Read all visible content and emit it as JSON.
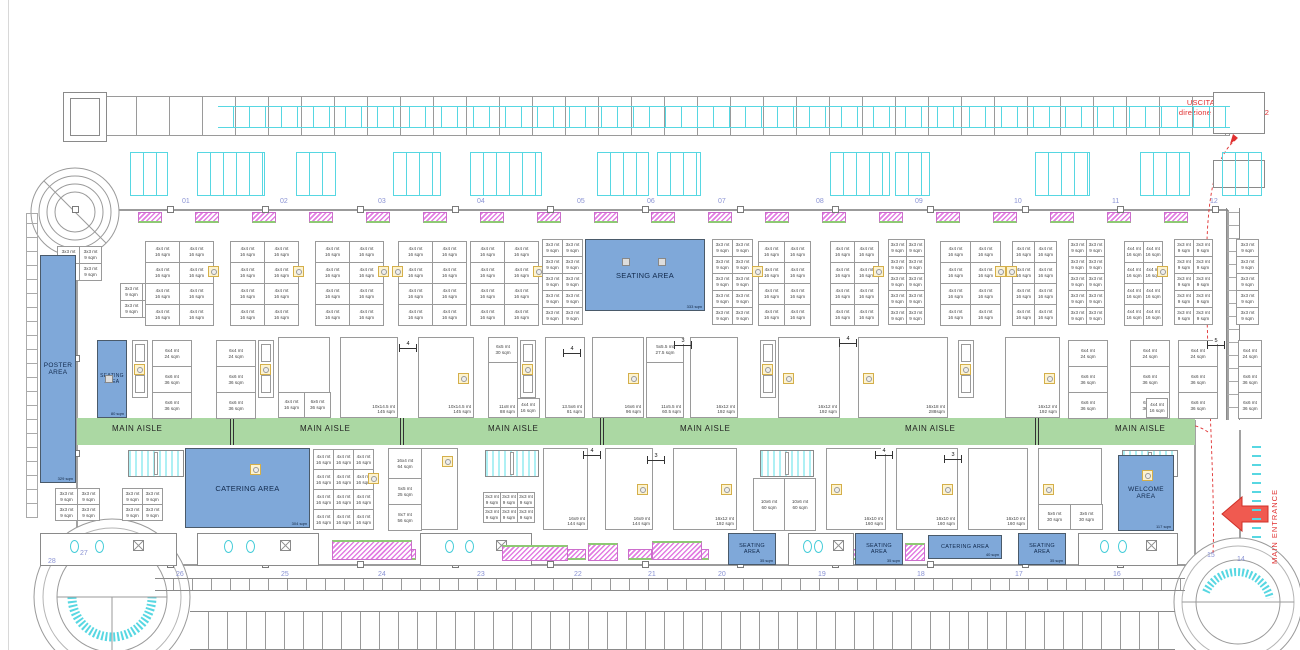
{
  "labels": {
    "main_aisle": "MAIN AISLE",
    "exit_line1": "USCITA AREA EXPO",
    "exit_line2": "direzione MiCo Sud liv +2",
    "main_entrance": "MAIN ENTRANCE"
  },
  "colors": {
    "area_blue": "#7fa8d9",
    "aisle_green": "#abd8a3",
    "alert_red": "#e03030",
    "cad_cyan": "#57d7e2",
    "cad_magenta": "#e27ce2",
    "number_blue": "#8a93d4",
    "booth_gray": "#9a9a9a",
    "marker_yellow": "#d4af4a"
  },
  "cell_types": {
    "t44": "4x4 mt\n16 sqm",
    "t33": "3x3 mt\n9 sqm",
    "c24": "6x4 mt\n24 sqm",
    "c36": "6x6 mt\n36 sqm",
    "c16": "4x4 mt\n16 sqm",
    "t60": "10x6 mt\n60 sqm"
  },
  "areas": [
    {
      "id": "poster-area",
      "label": "POSTER\nAREA",
      "sqm": "329 sqm",
      "x": 40,
      "y": 255,
      "w": 36,
      "h": 228,
      "fs": 6.5
    },
    {
      "id": "seating-area-left",
      "label": "SEATING\nAREA",
      "sqm": "80 sqm",
      "x": 97,
      "y": 340,
      "w": 30,
      "h": 78,
      "fs": 5
    },
    {
      "id": "seating-area-top",
      "label": "SEATING AREA",
      "sqm": "333 sqm",
      "x": 585,
      "y": 239,
      "w": 120,
      "h": 72,
      "fs": 7.5
    },
    {
      "id": "catering-area-main",
      "label": "CATERING AREA",
      "sqm": "304 sqm",
      "x": 185,
      "y": 448,
      "w": 125,
      "h": 80,
      "fs": 7.5
    },
    {
      "id": "welcome-area",
      "label": "WELCOME\nAREA",
      "sqm": "117 sqm",
      "x": 1118,
      "y": 455,
      "w": 56,
      "h": 76,
      "fs": 6.5
    },
    {
      "id": "seating-area-b1",
      "label": "SEATING\nAREA",
      "sqm": "35 sqm",
      "x": 728,
      "y": 533,
      "w": 48,
      "h": 32,
      "fs": 5.5
    },
    {
      "id": "seating-area-b2",
      "label": "SEATING\nAREA",
      "sqm": "35 sqm",
      "x": 855,
      "y": 533,
      "w": 48,
      "h": 32,
      "fs": 5.5
    },
    {
      "id": "catering-area-b",
      "label": "CATERING AREA",
      "sqm": "40 sqm",
      "x": 928,
      "y": 535,
      "w": 74,
      "h": 24,
      "fs": 5.5
    },
    {
      "id": "seating-area-b3",
      "label": "SEATING\nAREA",
      "sqm": "35 sqm",
      "x": 1018,
      "y": 533,
      "w": 48,
      "h": 32,
      "fs": 5.5
    }
  ],
  "aisle": {
    "x": 77,
    "y": 418,
    "w": 1118,
    "h": 27,
    "label_y": 424,
    "label_xs": [
      112,
      300,
      488,
      680,
      905,
      1115
    ],
    "tick_xs": [
      230,
      400,
      600,
      1035
    ]
  },
  "top_numbers": {
    "y": 198,
    "items": [
      {
        "n": "01",
        "x": 182
      },
      {
        "n": "02",
        "x": 280
      },
      {
        "n": "03",
        "x": 378
      },
      {
        "n": "04",
        "x": 477
      },
      {
        "n": "05",
        "x": 577
      },
      {
        "n": "06",
        "x": 647
      },
      {
        "n": "07",
        "x": 718
      },
      {
        "n": "08",
        "x": 816
      },
      {
        "n": "09",
        "x": 915
      },
      {
        "n": "10",
        "x": 1014
      },
      {
        "n": "11",
        "x": 1112
      },
      {
        "n": "12",
        "x": 1210
      }
    ]
  },
  "bottom_numbers": [
    {
      "n": "28",
      "x": 48,
      "y": 558
    },
    {
      "n": "27",
      "x": 80,
      "y": 550
    },
    {
      "n": "26",
      "x": 176,
      "y": 571
    },
    {
      "n": "25",
      "x": 281,
      "y": 571
    },
    {
      "n": "24",
      "x": 378,
      "y": 571
    },
    {
      "n": "23",
      "x": 477,
      "y": 571
    },
    {
      "n": "22",
      "x": 574,
      "y": 571
    },
    {
      "n": "21",
      "x": 648,
      "y": 571
    },
    {
      "n": "20",
      "x": 718,
      "y": 571
    },
    {
      "n": "19",
      "x": 818,
      "y": 571
    },
    {
      "n": "18",
      "x": 917,
      "y": 571
    },
    {
      "n": "17",
      "x": 1015,
      "y": 571
    },
    {
      "n": "16",
      "x": 1113,
      "y": 571
    },
    {
      "n": "15",
      "x": 1207,
      "y": 552
    },
    {
      "n": "14",
      "x": 1237,
      "y": 556
    }
  ],
  "booth_blocks": [
    {
      "x": 57,
      "y": 246,
      "cols": 2,
      "rows": 2,
      "cw": 22,
      "ch": 17,
      "type": "t33"
    },
    {
      "x": 120,
      "y": 283,
      "cols": 2,
      "rows": 2,
      "cw": 22,
      "ch": 17,
      "type": "t33"
    },
    {
      "x": 145,
      "y": 241,
      "cols": 2,
      "rows": 4,
      "cw": 34,
      "ch": 21,
      "type": "t44",
      "m": 1
    },
    {
      "x": 230,
      "y": 241,
      "cols": 2,
      "rows": 4,
      "cw": 34,
      "ch": 21,
      "type": "t44",
      "m": 1
    },
    {
      "x": 315,
      "y": 241,
      "cols": 2,
      "rows": 4,
      "cw": 34,
      "ch": 21,
      "type": "t44",
      "m": 1
    },
    {
      "x": 398,
      "y": 241,
      "cols": 2,
      "rows": 4,
      "cw": 34,
      "ch": 21,
      "type": "t44",
      "m": 0
    },
    {
      "x": 470,
      "y": 241,
      "cols": 2,
      "rows": 4,
      "cw": 34,
      "ch": 21,
      "type": "t44",
      "m": 1
    },
    {
      "x": 542,
      "y": 239,
      "cols": 2,
      "rows": 5,
      "cw": 20,
      "ch": 17,
      "type": "t33"
    },
    {
      "x": 712,
      "y": 239,
      "cols": 2,
      "rows": 5,
      "cw": 20,
      "ch": 17,
      "type": "t33"
    },
    {
      "x": 758,
      "y": 241,
      "cols": 2,
      "rows": 4,
      "cw": 26,
      "ch": 21,
      "type": "t44",
      "m": 0
    },
    {
      "x": 830,
      "y": 241,
      "cols": 2,
      "rows": 4,
      "cw": 24,
      "ch": 21,
      "type": "t44",
      "m": 1
    },
    {
      "x": 888,
      "y": 239,
      "cols": 2,
      "rows": 5,
      "cw": 18,
      "ch": 17,
      "type": "t33"
    },
    {
      "x": 940,
      "y": 241,
      "cols": 2,
      "rows": 4,
      "cw": 30,
      "ch": 21,
      "type": "t44",
      "m": 1
    },
    {
      "x": 1012,
      "y": 241,
      "cols": 2,
      "rows": 4,
      "cw": 22,
      "ch": 21,
      "type": "t44",
      "m": 0
    },
    {
      "x": 1068,
      "y": 239,
      "cols": 2,
      "rows": 5,
      "cw": 18,
      "ch": 17,
      "type": "t33"
    },
    {
      "x": 1124,
      "y": 241,
      "cols": 2,
      "rows": 4,
      "cw": 19,
      "ch": 21,
      "type": "t44",
      "m": 1
    },
    {
      "x": 1174,
      "y": 239,
      "cols": 2,
      "rows": 5,
      "cw": 19,
      "ch": 17,
      "type": "t33"
    },
    {
      "x": 1236,
      "y": 239,
      "cols": 1,
      "rows": 5,
      "cw": 22,
      "ch": 17,
      "type": "t33"
    },
    {
      "x": 55,
      "y": 488,
      "cols": 2,
      "rows": 2,
      "cw": 22,
      "ch": 16,
      "type": "t33"
    },
    {
      "x": 122,
      "y": 488,
      "cols": 2,
      "rows": 2,
      "cw": 20,
      "ch": 16,
      "type": "t33"
    },
    {
      "x": 313,
      "y": 449,
      "cols": 3,
      "rows": 4,
      "cw": 20,
      "ch": 20,
      "type": "t44",
      "m": 1
    },
    {
      "x": 483,
      "y": 492,
      "cols": 3,
      "rows": 2,
      "cw": 17,
      "ch": 15,
      "type": "t33"
    },
    {
      "x": 753,
      "y": 478,
      "cols": 2,
      "rows": 1,
      "cw": 31,
      "ch": 52,
      "type": "t60"
    }
  ],
  "stack_blocks": [
    {
      "x": 152,
      "y": 340,
      "w": 40
    },
    {
      "x": 216,
      "y": 340,
      "w": 40
    },
    {
      "x": 1068,
      "y": 340,
      "w": 40
    },
    {
      "x": 1130,
      "y": 340,
      "w": 40
    },
    {
      "x": 1178,
      "y": 340,
      "w": 40
    },
    {
      "x": 1238,
      "y": 340,
      "w": 24
    }
  ],
  "stack_cells": [
    "c24",
    "c36",
    "c36"
  ],
  "big_booths": [
    {
      "x": 278,
      "y": 337,
      "w": 52,
      "h": 81,
      "l": "",
      "bottom": [
        "4x4 mt\n16 sqm",
        "6x6 mt\n36 sqm"
      ]
    },
    {
      "x": 340,
      "y": 337,
      "w": 58,
      "h": 81,
      "l": "10x14.5 mt\n145 sqm"
    },
    {
      "x": 418,
      "y": 337,
      "w": 56,
      "h": 81,
      "l": "10x14.5 mt\n145 sqm",
      "m": 1
    },
    {
      "x": 488,
      "y": 337,
      "w": 30,
      "h": 81,
      "l": "11x8 mt\n88 sqm",
      "top": "6x5 mt\n30 sqm"
    },
    {
      "x": 545,
      "y": 337,
      "w": 40,
      "h": 81,
      "l": "13.5x6 mt\n81 sqm"
    },
    {
      "x": 592,
      "y": 337,
      "w": 52,
      "h": 81,
      "l": "16x6 mt\n96 sqm",
      "m": 1
    },
    {
      "x": 646,
      "y": 337,
      "w": 38,
      "h": 81,
      "l": "11x5.5 mt\n60.5 sqm",
      "top": "5x5.5 mt\n27.5 sqm"
    },
    {
      "x": 690,
      "y": 337,
      "w": 48,
      "h": 81,
      "l": "16x12 mt\n192 sqm"
    },
    {
      "x": 778,
      "y": 337,
      "w": 62,
      "h": 81,
      "l": "16x12 mt\n192 sqm",
      "m": 0
    },
    {
      "x": 858,
      "y": 337,
      "w": 90,
      "h": 81,
      "l": "16x18 mt\n288sqm",
      "m": 0
    },
    {
      "x": 1005,
      "y": 337,
      "w": 55,
      "h": 81,
      "l": "16x12 mt\n192 sqm",
      "m": 1
    },
    {
      "x": 543,
      "y": 448,
      "w": 45,
      "h": 82,
      "l": "16x9 mt\n144 sqm"
    },
    {
      "x": 605,
      "y": 448,
      "w": 48,
      "h": 82,
      "l": "16x9 mt\n144 sqm",
      "m": 1
    },
    {
      "x": 673,
      "y": 448,
      "w": 64,
      "h": 82,
      "l": "16x12 mt\n192 sqm",
      "m": 1
    },
    {
      "x": 826,
      "y": 448,
      "w": 60,
      "h": 82,
      "l": "16x10 mt\n160 sqm",
      "m": 0
    },
    {
      "x": 896,
      "y": 448,
      "w": 62,
      "h": 82,
      "l": "16x10 mt\n160 sqm",
      "m": 1
    },
    {
      "x": 968,
      "y": 448,
      "w": 60,
      "h": 82,
      "l": "16x10 mt\n160 sqm"
    },
    {
      "x": 1038,
      "y": 448,
      "w": 64,
      "h": 82,
      "l": "11x12 mt\n132 sqm",
      "m": 0,
      "bottom": [
        "5x6 mt\n30 sqm",
        "3x6 mt\n30 sqm"
      ]
    }
  ],
  "column_booth": {
    "x": 388,
    "y": 448,
    "w": 70,
    "leftw": 34,
    "cells": [
      {
        "l": "16x4 mt\n64 sqm",
        "h": 30
      },
      {
        "l": "5x5 mt\n25 sqm",
        "h": 26
      },
      {
        "l": "8x7 mt\n56 sqm",
        "h": 26
      }
    ]
  },
  "under_strip_cells": [
    {
      "x": 516,
      "y": 398,
      "w": 24,
      "h": 20
    },
    {
      "x": 1146,
      "y": 398,
      "w": 22,
      "h": 20
    }
  ],
  "dims": [
    {
      "x": 408,
      "y": 344,
      "t": "4"
    },
    {
      "x": 572,
      "y": 349,
      "t": "4"
    },
    {
      "x": 683,
      "y": 341,
      "t": "3"
    },
    {
      "x": 848,
      "y": 339,
      "t": "4"
    },
    {
      "x": 1216,
      "y": 341,
      "t": "5"
    },
    {
      "x": 592,
      "y": 451,
      "t": "4"
    },
    {
      "x": 656,
      "y": 456,
      "t": "3"
    },
    {
      "x": 884,
      "y": 451,
      "t": "4"
    },
    {
      "x": 953,
      "y": 455,
      "t": "3"
    }
  ],
  "strips": [
    132,
    258,
    520,
    760,
    958,
    1150
  ],
  "escalators": [
    {
      "x": 128,
      "w": 56
    },
    {
      "x": 485,
      "w": 54
    },
    {
      "x": 760,
      "w": 54
    },
    {
      "x": 1122,
      "w": 56
    }
  ],
  "decor": {
    "radiators_top": [
      138,
      195,
      252,
      309,
      366,
      423,
      480,
      537,
      594,
      651,
      708,
      765,
      822,
      879,
      936,
      993,
      1050,
      1107,
      1164
    ],
    "radiators_bottom": [
      335,
      392,
      505,
      562,
      628,
      685,
      795,
      852
    ],
    "cyan_groups": [
      {
        "x": 130,
        "w": 38
      },
      {
        "x": 197,
        "w": 68
      },
      {
        "x": 296,
        "w": 40
      },
      {
        "x": 393,
        "w": 48
      },
      {
        "x": 470,
        "w": 72
      },
      {
        "x": 597,
        "w": 52
      },
      {
        "x": 657,
        "w": 44
      },
      {
        "x": 830,
        "w": 60
      },
      {
        "x": 895,
        "w": 35
      },
      {
        "x": 1035,
        "w": 55
      },
      {
        "x": 1140,
        "w": 50
      },
      {
        "x": 1222,
        "w": 40
      }
    ],
    "facilities": [
      {
        "x": 40,
        "w": 137
      },
      {
        "x": 197,
        "w": 122
      },
      {
        "x": 420,
        "w": 112
      },
      {
        "x": 788,
        "w": 66
      },
      {
        "x": 1078,
        "w": 100
      }
    ],
    "tables": [
      {
        "x": 332,
        "y": 540,
        "w": 80,
        "h": 20
      },
      {
        "x": 502,
        "y": 545,
        "w": 66,
        "h": 16
      },
      {
        "x": 588,
        "y": 543,
        "w": 30,
        "h": 18
      },
      {
        "x": 652,
        "y": 541,
        "w": 50,
        "h": 19
      },
      {
        "x": 905,
        "y": 543,
        "w": 20,
        "h": 18
      }
    ],
    "col_squares_top": [
      75,
      170,
      265,
      360,
      455,
      550,
      645,
      740,
      835,
      930,
      1025,
      1120,
      1215
    ],
    "col_squares_bottom": [
      170,
      265,
      360,
      455,
      550,
      645,
      740,
      835,
      930,
      1025,
      1120
    ],
    "col_squares_left_y": [
      260,
      355,
      450
    ],
    "area_gray_marks": [
      {
        "x": 622,
        "y": 258
      },
      {
        "x": 658,
        "y": 258
      },
      {
        "x": 105,
        "y": 375
      }
    ],
    "area_yellow_marks": [
      {
        "x": 250,
        "y": 464
      },
      {
        "x": 1142,
        "y": 470
      }
    ]
  }
}
